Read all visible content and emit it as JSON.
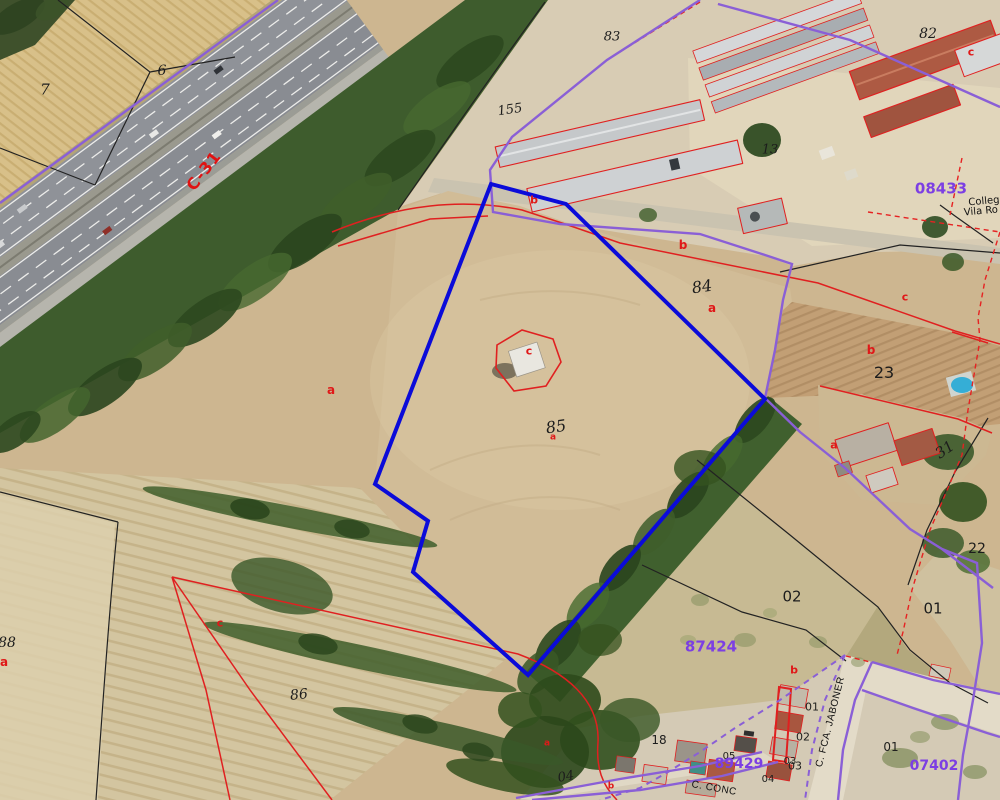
{
  "map": {
    "description": "Aerial orthophoto with cadastral parcel overlay",
    "selected_parcel": "85"
  },
  "colors": {
    "selected_parcel_outline": "#0b0bd9",
    "boundary_purple": "#8a5fd6",
    "cadastral_red": "#e02020",
    "block_label_purple": "#7c3fe3",
    "road_label_red": "#e01212",
    "parcel_label_black": "#1c1c1c"
  },
  "labels": [
    {
      "t": "7",
      "x": 45,
      "y": 90,
      "c": "pi",
      "s": 15
    },
    {
      "t": "6",
      "x": 162,
      "y": 71,
      "c": "pi",
      "s": 14
    },
    {
      "t": "C-31",
      "x": 204,
      "y": 171,
      "c": "road",
      "r": -52,
      "s": 16
    },
    {
      "t": "155",
      "x": 510,
      "y": 110,
      "c": "pi",
      "r": -8,
      "s": 13
    },
    {
      "t": "83",
      "x": 612,
      "y": 37,
      "c": "pi",
      "s": 13
    },
    {
      "t": "82",
      "x": 928,
      "y": 34,
      "c": "pi",
      "s": 14
    },
    {
      "t": "c",
      "x": 971,
      "y": 52,
      "c": "rl",
      "s": 11
    },
    {
      "t": "08433",
      "x": 941,
      "y": 189,
      "c": "blk",
      "s": 15
    },
    {
      "t": "Colleg",
      "x": 984,
      "y": 202,
      "c": "pn",
      "r": -5,
      "s": 10
    },
    {
      "t": "Vila Ro",
      "x": 981,
      "y": 212,
      "c": "pn",
      "r": -5,
      "s": 10
    },
    {
      "t": "13",
      "x": 770,
      "y": 150,
      "c": "pi",
      "s": 13
    },
    {
      "t": "b",
      "x": 534,
      "y": 200,
      "c": "rl",
      "s": 11
    },
    {
      "t": "b",
      "x": 683,
      "y": 245,
      "c": "rl",
      "s": 12
    },
    {
      "t": "84",
      "x": 702,
      "y": 287,
      "c": "pi",
      "r": -8,
      "s": 16
    },
    {
      "t": "a",
      "x": 712,
      "y": 308,
      "c": "rl",
      "s": 12
    },
    {
      "t": "c",
      "x": 529,
      "y": 351,
      "c": "rl",
      "s": 11
    },
    {
      "t": "85",
      "x": 556,
      "y": 427,
      "c": "pi",
      "r": -8,
      "s": 16
    },
    {
      "t": "a",
      "x": 553,
      "y": 438,
      "c": "rl",
      "s": 9
    },
    {
      "t": "a",
      "x": 331,
      "y": 390,
      "c": "rl",
      "s": 12
    },
    {
      "t": "c",
      "x": 905,
      "y": 297,
      "c": "rl",
      "s": 11
    },
    {
      "t": "b",
      "x": 871,
      "y": 350,
      "c": "rl",
      "s": 12
    },
    {
      "t": "23",
      "x": 884,
      "y": 373,
      "c": "pn2",
      "s": 16
    },
    {
      "t": "a",
      "x": 834,
      "y": 445,
      "c": "rl",
      "s": 11
    },
    {
      "t": "31",
      "x": 945,
      "y": 450,
      "c": "pi",
      "r": -35,
      "s": 15
    },
    {
      "t": "22",
      "x": 977,
      "y": 549,
      "c": "pn2",
      "s": 14
    },
    {
      "t": "02",
      "x": 792,
      "y": 597,
      "c": "pn2",
      "s": 15
    },
    {
      "t": "01",
      "x": 933,
      "y": 609,
      "c": "pn2",
      "s": 15
    },
    {
      "t": "87424",
      "x": 711,
      "y": 647,
      "c": "blk",
      "s": 15
    },
    {
      "t": "b",
      "x": 794,
      "y": 670,
      "c": "rl",
      "s": 11
    },
    {
      "t": "88",
      "x": 7,
      "y": 643,
      "c": "pi",
      "s": 14
    },
    {
      "t": "a",
      "x": 4,
      "y": 662,
      "c": "rl",
      "s": 12
    },
    {
      "t": "c",
      "x": 220,
      "y": 623,
      "c": "rl",
      "s": 11
    },
    {
      "t": "86",
      "x": 299,
      "y": 695,
      "c": "pi",
      "r": -6,
      "s": 14
    },
    {
      "t": "04",
      "x": 566,
      "y": 777,
      "c": "pi",
      "r": -10,
      "s": 13
    },
    {
      "t": "b",
      "x": 611,
      "y": 787,
      "c": "rl",
      "s": 9
    },
    {
      "t": "a",
      "x": 547,
      "y": 744,
      "c": "rl",
      "s": 9
    },
    {
      "t": "18",
      "x": 659,
      "y": 740,
      "c": "pn2",
      "s": 12
    },
    {
      "t": "05",
      "x": 729,
      "y": 757,
      "c": "hn",
      "s": 10
    },
    {
      "t": "03",
      "x": 790,
      "y": 762,
      "c": "hn",
      "s": 10
    },
    {
      "t": "04",
      "x": 768,
      "y": 780,
      "c": "hn",
      "s": 10
    },
    {
      "t": "01",
      "x": 812,
      "y": 707,
      "c": "hn",
      "s": 11
    },
    {
      "t": "02",
      "x": 803,
      "y": 737,
      "c": "hn",
      "s": 11
    },
    {
      "t": "03",
      "x": 795,
      "y": 766,
      "c": "hn",
      "s": 11
    },
    {
      "t": "01",
      "x": 891,
      "y": 747,
      "c": "hn",
      "s": 12
    },
    {
      "t": "89429",
      "x": 739,
      "y": 764,
      "c": "blk",
      "s": 14
    },
    {
      "t": "07402",
      "x": 934,
      "y": 766,
      "c": "blk",
      "s": 14
    },
    {
      "t": "C. FCA. JABONER",
      "x": 831,
      "y": 722,
      "c": "st",
      "r": -76,
      "s": 10
    },
    {
      "t": "C. CONC",
      "x": 714,
      "y": 789,
      "c": "st",
      "r": 10,
      "s": 10
    }
  ]
}
